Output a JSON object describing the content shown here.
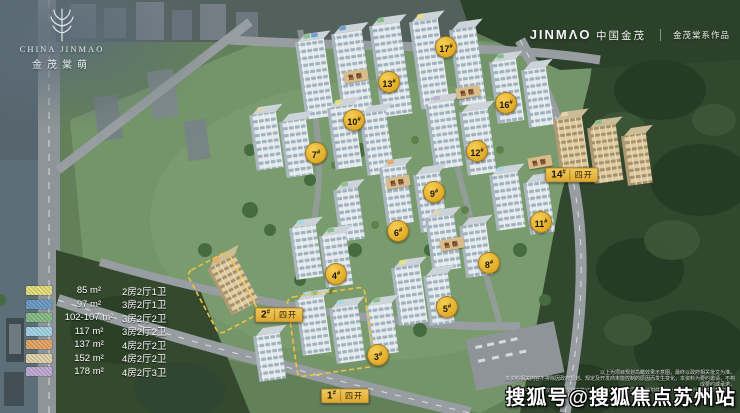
{
  "branding": {
    "top_left": {
      "name_en": "CHINA JINMAO",
      "name_cn": "金茂棠萌"
    },
    "top_right": {
      "en": "JINMΛO",
      "cn": "中国金茂",
      "series_mark": "金茂棠系作品"
    }
  },
  "legend": {
    "items": [
      {
        "color": "#e6e17d",
        "area": "85 m²",
        "layout": "2房2厅1卫"
      },
      {
        "color": "#6f9fc8",
        "area": "97 m²",
        "layout": "3房2厅1卫"
      },
      {
        "color": "#8abf8a",
        "area": "102-107 m²",
        "layout": "3房2厅2卫"
      },
      {
        "color": "#a8d8e8",
        "area": "117 m²",
        "layout": "3房2厅2卫"
      },
      {
        "color": "#e8a868",
        "area": "137 m²",
        "layout": "4房2厅2卫"
      },
      {
        "color": "#e3d4ae",
        "area": "152 m²",
        "layout": "4房2厅2卫"
      },
      {
        "color": "#c3aed6",
        "area": "178 m²",
        "layout": "4房2厅3卫"
      }
    ]
  },
  "site": {
    "circle_badges": [
      "17#",
      "16#",
      "13#",
      "12#",
      "11#",
      "10#",
      "9#",
      "8#",
      "7#",
      "6#",
      "5#",
      "4#",
      "3#"
    ],
    "batch_labels": [
      {
        "num": "1#",
        "tag": "四开"
      },
      {
        "num": "2#",
        "tag": "四开"
      },
      {
        "num": "14#",
        "tag": "四开"
      }
    ],
    "soldout_text": "售罄"
  },
  "watermark": {
    "text": "搜狐号@搜狐焦点苏州站"
  },
  "disclaimer": {
    "lines": [
      "以上为项目规划鸟瞰效果示意图，最终以政府相关批文为准。",
      "本资料相关内容不排除因政府规划、规定及开发商未能控制的原因而发生变化，本资料为要约邀请，不构成要约或承诺，",
      "买卖双方的权利义务以双方签订的《商品房买卖合同》及其附件等协议为准。敬请留意最新资料。"
    ]
  }
}
